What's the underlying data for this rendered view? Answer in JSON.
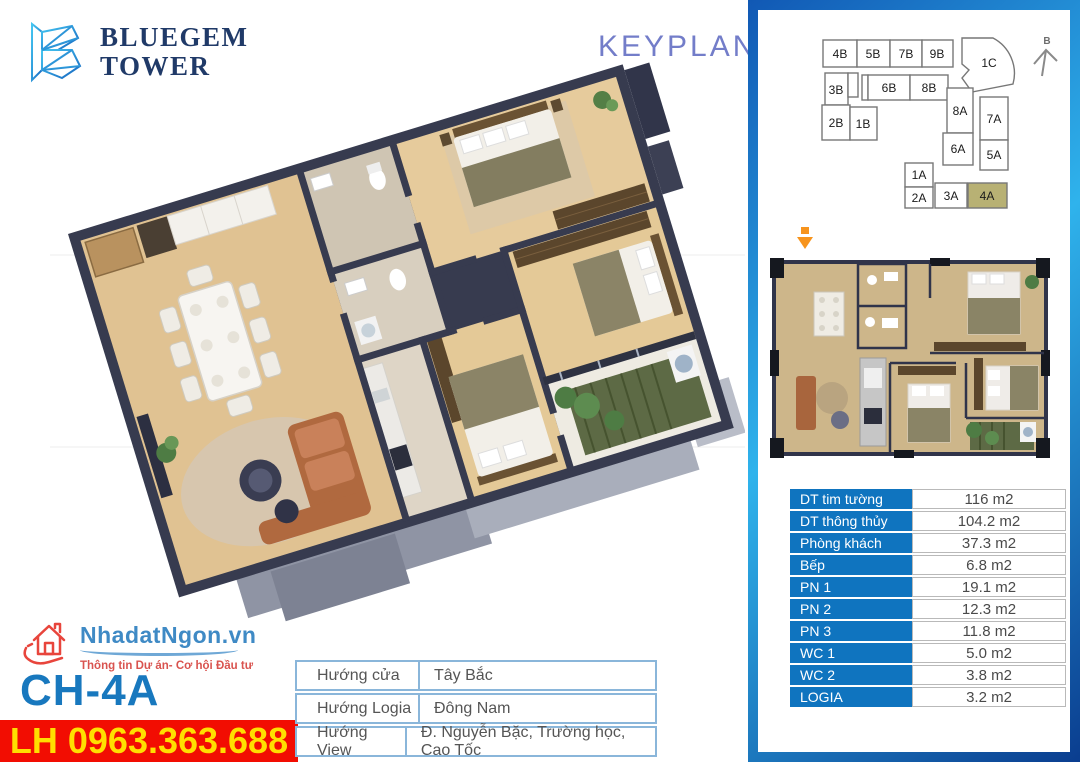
{
  "header": {
    "brand_line1": "BLUEGEM",
    "brand_line2": "TOWER",
    "keyplan_label": "KEYPLAN"
  },
  "sidebar": {
    "compass_label": "B",
    "keyplan_units": [
      {
        "label": "4B"
      },
      {
        "label": "5B"
      },
      {
        "label": "7B"
      },
      {
        "label": "9B"
      },
      {
        "label": "1C"
      },
      {
        "label": "3B"
      },
      {
        "label": "6B"
      },
      {
        "label": "8B"
      },
      {
        "label": "2B"
      },
      {
        "label": "1B"
      },
      {
        "label": "8A"
      },
      {
        "label": "7A"
      },
      {
        "label": "6A"
      },
      {
        "label": "5A"
      },
      {
        "label": "1A"
      },
      {
        "label": "2A"
      },
      {
        "label": "3A"
      },
      {
        "label": "4A"
      }
    ],
    "highlighted_unit": "4A",
    "areas": {
      "rows": [
        {
          "label": "DT tim tường",
          "value": "116 m2"
        },
        {
          "label": "DT thông thủy",
          "value": "104.2 m2"
        },
        {
          "label": "Phòng khách",
          "value": "37.3 m2"
        },
        {
          "label": "Bếp",
          "value": "6.8 m2"
        },
        {
          "label": "PN 1",
          "value": "19.1 m2"
        },
        {
          "label": "PN 2",
          "value": "12.3 m2"
        },
        {
          "label": "PN 3",
          "value": "11.8 m2"
        },
        {
          "label": "WC 1",
          "value": "5.0 m2"
        },
        {
          "label": "WC 2",
          "value": "3.8 m2"
        },
        {
          "label": "LOGIA",
          "value": "3.2 m2"
        }
      ]
    }
  },
  "footer": {
    "agency_site": "NhadatNgon.vn",
    "agency_tagline": "Thông tin Dự án- Cơ hội Đầu tư",
    "unit_code": "CH-4A",
    "hotline": "LH 0963.363.688",
    "orientation": {
      "rows": [
        {
          "label": "Hướng cửa",
          "value": "Tây Bắc"
        },
        {
          "label": "Hướng Logia",
          "value": "Đông Nam"
        },
        {
          "label": "Hướng View",
          "value": "Đ. Nguyễn Bặc, Trường học, Cao Tốc"
        }
      ]
    }
  },
  "colors": {
    "panel_blue_dark": "#0a3d8f",
    "panel_blue_light": "#2fb3ec",
    "table_label_blue": "#0f74bf",
    "highlight_khaki": "#b8b174",
    "unit_code_blue": "#1878be",
    "hotline_red": "#f20d02",
    "hotline_yellow": "#ffdf00",
    "keyplan_title_indigo": "#737dc9",
    "marker_orange": "#f7941d"
  }
}
